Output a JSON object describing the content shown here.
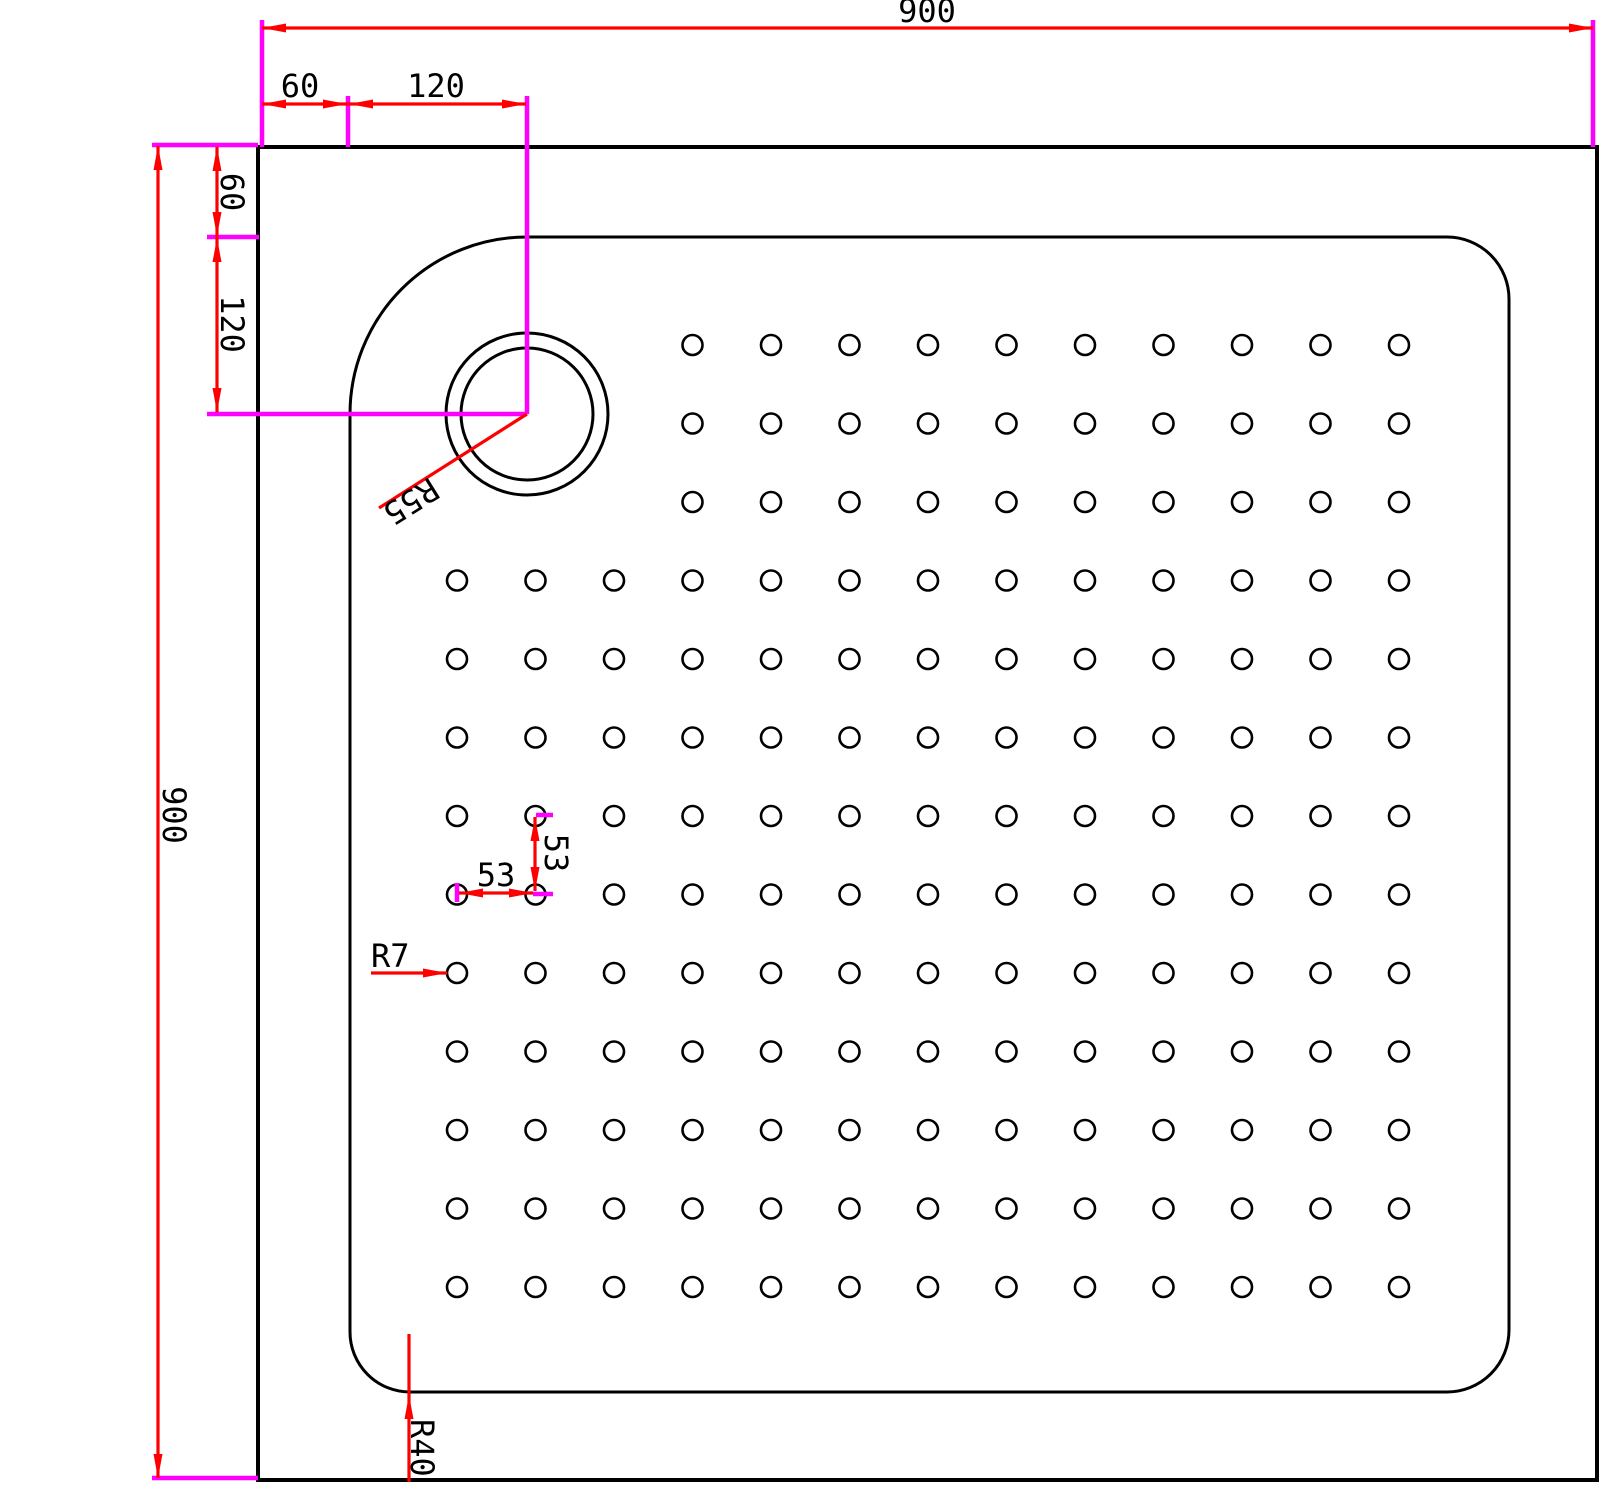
{
  "dimension_labels": {
    "overall_width": "900",
    "overall_height": "900",
    "top_offset_wall": "60",
    "top_offset_drain": "120",
    "left_offset_wall": "60",
    "left_offset_drain": "120",
    "drain_radius": "R55",
    "dot_spacing_h": "53",
    "dot_spacing_v": "53",
    "dot_radius": "R7",
    "basin_corner_radius": "R40"
  },
  "colors": {
    "geometry": "#000000",
    "dimension": "#ff0000",
    "extension": "#ff00ff",
    "background": "#ffffff"
  },
  "dot_grid": {
    "rows": 13,
    "cols": 13,
    "short_rows": 3,
    "short_row_start_col": 4,
    "pitch_px": 78.5,
    "origin_x": 457,
    "origin_y": 345,
    "dot_radius_px": 10
  }
}
